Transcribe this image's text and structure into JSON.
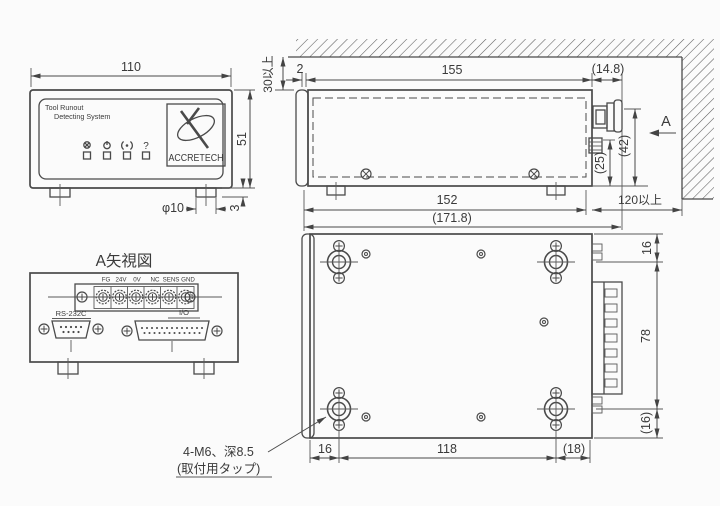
{
  "front_view": {
    "label_line1": "Tool Runout",
    "label_line2": "Detecting System",
    "brand": "ACCRETECH",
    "indicator_icons": [
      "run-icon",
      "power-icon",
      "signal-icon",
      "question-icon"
    ],
    "help_glyph": "?",
    "dims": {
      "width": "110",
      "height": "51",
      "foot_dia": "φ10",
      "foot_height": "3"
    }
  },
  "plan_view": {
    "view_label": "A",
    "dims": {
      "wall_clearance": "30以上",
      "lid_gap": "2",
      "body_depth": "155",
      "connector_protrusion": "(14.8)",
      "connector_top_height": "(42)",
      "connector_mid_height": "(25)",
      "base_depth": "152",
      "overall_depth": "(171.8)",
      "rear_clearance": "120以上"
    }
  },
  "view_a": {
    "title": "A矢視図",
    "terminal_labels": [
      "FG",
      "24V",
      "0V",
      "NC",
      "SENS",
      "GND"
    ],
    "rs232c_label": "RS-232C",
    "io_label": "I/O"
  },
  "bottom_view": {
    "dims": {
      "edge_top": "16",
      "connector_span": "78",
      "edge_bottom": "(16)",
      "edge_left": "16",
      "hole_pitch": "118",
      "edge_right": "(18)"
    },
    "callout_line1": "4-M6、深8.5",
    "callout_line2": "(取付用タップ)"
  }
}
